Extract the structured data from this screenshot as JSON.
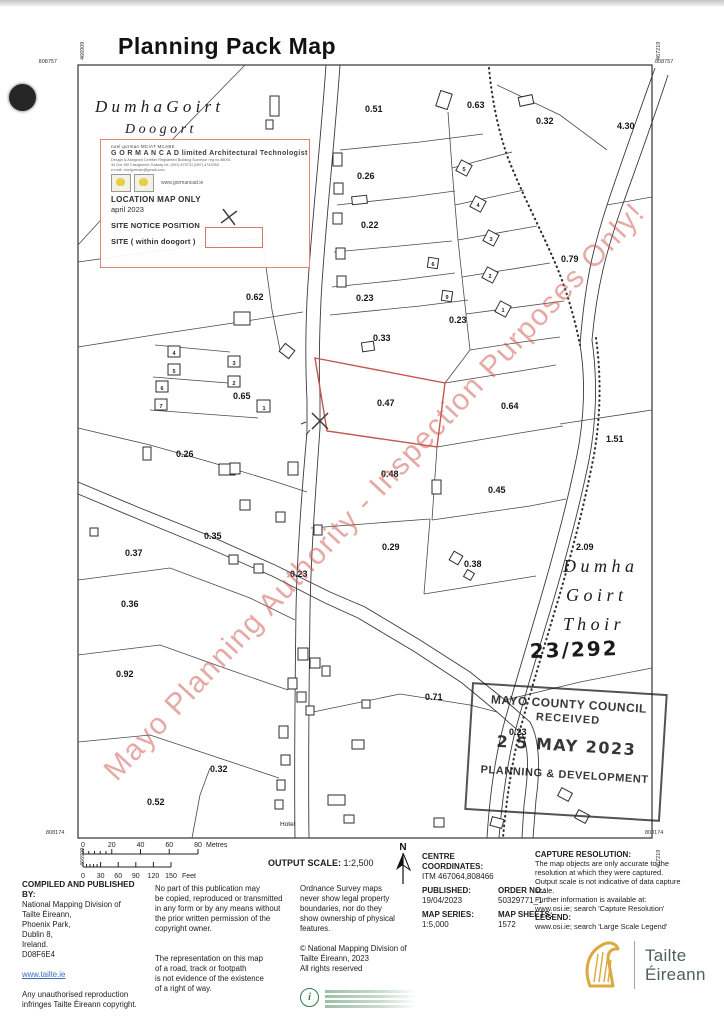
{
  "title": "Planning Pack Map",
  "corners": {
    "top_left_n": "808757",
    "top_right_n": "808757",
    "bottom_left_n": "808174",
    "bottom_right_n": "808174",
    "left_e": "466909",
    "right_e": "467219"
  },
  "map": {
    "townland_nw_1": "D u m h a    G o i r t",
    "townland_nw_2": "D o o g o r t",
    "townland_e_1": "D u m h a",
    "townland_e_2": "G o i r t",
    "townland_e_3": "T h o i r",
    "plot_ref": "23/292",
    "hotel_label": "Hotel",
    "plot_labels": [
      {
        "t": "0.51",
        "x": 365,
        "y": 112
      },
      {
        "t": "0.63",
        "x": 467,
        "y": 108
      },
      {
        "t": "0.32",
        "x": 536,
        "y": 124
      },
      {
        "t": "4.30",
        "x": 617,
        "y": 129
      },
      {
        "t": "0.26",
        "x": 357,
        "y": 179
      },
      {
        "t": "0.22",
        "x": 361,
        "y": 228
      },
      {
        "t": "0.79",
        "x": 561,
        "y": 262
      },
      {
        "t": "0.23",
        "x": 356,
        "y": 301
      },
      {
        "t": "0.23",
        "x": 449,
        "y": 323
      },
      {
        "t": "0.62",
        "x": 246,
        "y": 300
      },
      {
        "t": "0.33",
        "x": 373,
        "y": 341
      },
      {
        "t": "0.65",
        "x": 233,
        "y": 399
      },
      {
        "t": "0.47",
        "x": 377,
        "y": 406
      },
      {
        "t": "0.64",
        "x": 501,
        "y": 409
      },
      {
        "t": "1.51",
        "x": 606,
        "y": 442
      },
      {
        "t": "0.26",
        "x": 176,
        "y": 457
      },
      {
        "t": "0.48",
        "x": 381,
        "y": 477
      },
      {
        "t": "0.45",
        "x": 488,
        "y": 493
      },
      {
        "t": "0.35",
        "x": 204,
        "y": 539
      },
      {
        "t": "0.29",
        "x": 382,
        "y": 550
      },
      {
        "t": "0.37",
        "x": 125,
        "y": 556
      },
      {
        "t": "0.38",
        "x": 464,
        "y": 567
      },
      {
        "t": "2.09",
        "x": 576,
        "y": 550
      },
      {
        "t": "0.23",
        "x": 290,
        "y": 577
      },
      {
        "t": "0.36",
        "x": 121,
        "y": 607
      },
      {
        "t": "0.92",
        "x": 116,
        "y": 677
      },
      {
        "t": "0.71",
        "x": 425,
        "y": 700
      },
      {
        "t": "0.23",
        "x": 509,
        "y": 735
      },
      {
        "t": "0.32",
        "x": 210,
        "y": 772
      },
      {
        "t": "0.52",
        "x": 147,
        "y": 805
      }
    ],
    "house_numbers": [
      {
        "t": "4",
        "x": 174,
        "y": 355
      },
      {
        "t": "5",
        "x": 174,
        "y": 373
      },
      {
        "t": "6",
        "x": 162,
        "y": 390
      },
      {
        "t": "7",
        "x": 161,
        "y": 408
      },
      {
        "t": "3",
        "x": 234,
        "y": 365
      },
      {
        "t": "2",
        "x": 234,
        "y": 385
      },
      {
        "t": "1",
        "x": 264,
        "y": 410
      },
      {
        "t": "5",
        "x": 464,
        "y": 171
      },
      {
        "t": "4",
        "x": 478,
        "y": 207
      },
      {
        "t": "3",
        "x": 491,
        "y": 241
      },
      {
        "t": "2",
        "x": 490,
        "y": 278
      },
      {
        "t": "1",
        "x": 503,
        "y": 312
      },
      {
        "t": "6",
        "x": 433,
        "y": 266
      },
      {
        "t": "9",
        "x": 447,
        "y": 299
      }
    ]
  },
  "legend_box": {
    "line1": "noel gorman   MCIAT   MCABE",
    "line2": "G O R M A N C A D limited  Architectural Technologist",
    "line3": "Design & Assigned Certifier      Registered Building Surveyor reg no 88091",
    "line4": "34 Gor Hill Claughwell, Galway      tel: (091) 879731  (087) 4742953",
    "line5": "e-mail: noelgorman@gmail.com",
    "website": "www.gormancad.ie",
    "location_line": "LOCATION  MAP ONLY",
    "date_line": "april 2023",
    "site_notice_line": "SITE NOTICE POSITION",
    "site_line": "SITE ( within doogort )"
  },
  "stamp": {
    "line1": "MAYO COUNTY COUNCIL",
    "line2": "RECEIVED",
    "date": "2 5 MAY  2023",
    "line3": "PLANNING & DEVELOPMENT"
  },
  "watermark": "Mayo Planning Authority - Inspection Purposes Only!",
  "footer": {
    "scalebar": {
      "metres_ticks": [
        "0",
        "20",
        "40",
        "60",
        "80"
      ],
      "metres_unit": "Metres",
      "feet_ticks": [
        "0",
        "30",
        "60",
        "90",
        "120",
        "150"
      ],
      "feet_unit": "Feet"
    },
    "output_scale_label": "OUTPUT SCALE:",
    "output_scale_value": "1:2,500",
    "north": "N",
    "centre": {
      "l1": "CENTRE",
      "l2": "COORDINATES:",
      "value": "ITM   467064,808466"
    },
    "published_label": "PUBLISHED:",
    "published_value": "19/04/2023",
    "order_label": "ORDER NO.:",
    "order_value": "50329771_1",
    "series_label": "MAP SERIES:",
    "series_value": "1:5,000",
    "sheets_label": "MAP SHEETS:",
    "sheets_value": "1572",
    "capture": {
      "heading": "CAPTURE RESOLUTION:",
      "lines": [
        "The map objects are only accurate to the",
        "resolution at which they were captured.",
        "Output scale is not indicative of data capture",
        "scale.",
        "Further information is available at:",
        "www.osi.ie; search 'Capture Resolution'"
      ],
      "legend_heading": "LEGEND:",
      "legend_line": "www.osi.ie; search 'Large Scale Legend'"
    },
    "compiled": {
      "heading": "COMPILED AND PUBLISHED BY:",
      "lines": [
        "National Mapping Division of",
        "Tailte Éireann,",
        "Phoenix Park,",
        "Dublin 8,",
        "Ireland.",
        "D08F6E4"
      ],
      "link": "www.tailte.ie",
      "repro_lines": [
        "Any unauthorised reproduction",
        "infringes Tailte Éireann copyright."
      ]
    },
    "col2a": [
      "No part of this publication may",
      "be copied, reproduced or transmitted",
      "in any form or by any means without",
      "the prior written permission of the",
      "copyright owner."
    ],
    "col2b": [
      "The representation on this map",
      "of a road, track or footpath",
      "is not evidence of the existence",
      "of a right of way."
    ],
    "col3a": [
      "Ordnance Survey maps",
      "never show legal property",
      "boundaries, nor do they",
      "show ownership of physical",
      "features."
    ],
    "col3b": [
      "© National Mapping Division of",
      "Tailte Éireann, 2023",
      "All rights reserved"
    ],
    "logo": {
      "l1": "Tailte",
      "l2": "Éireann"
    }
  }
}
